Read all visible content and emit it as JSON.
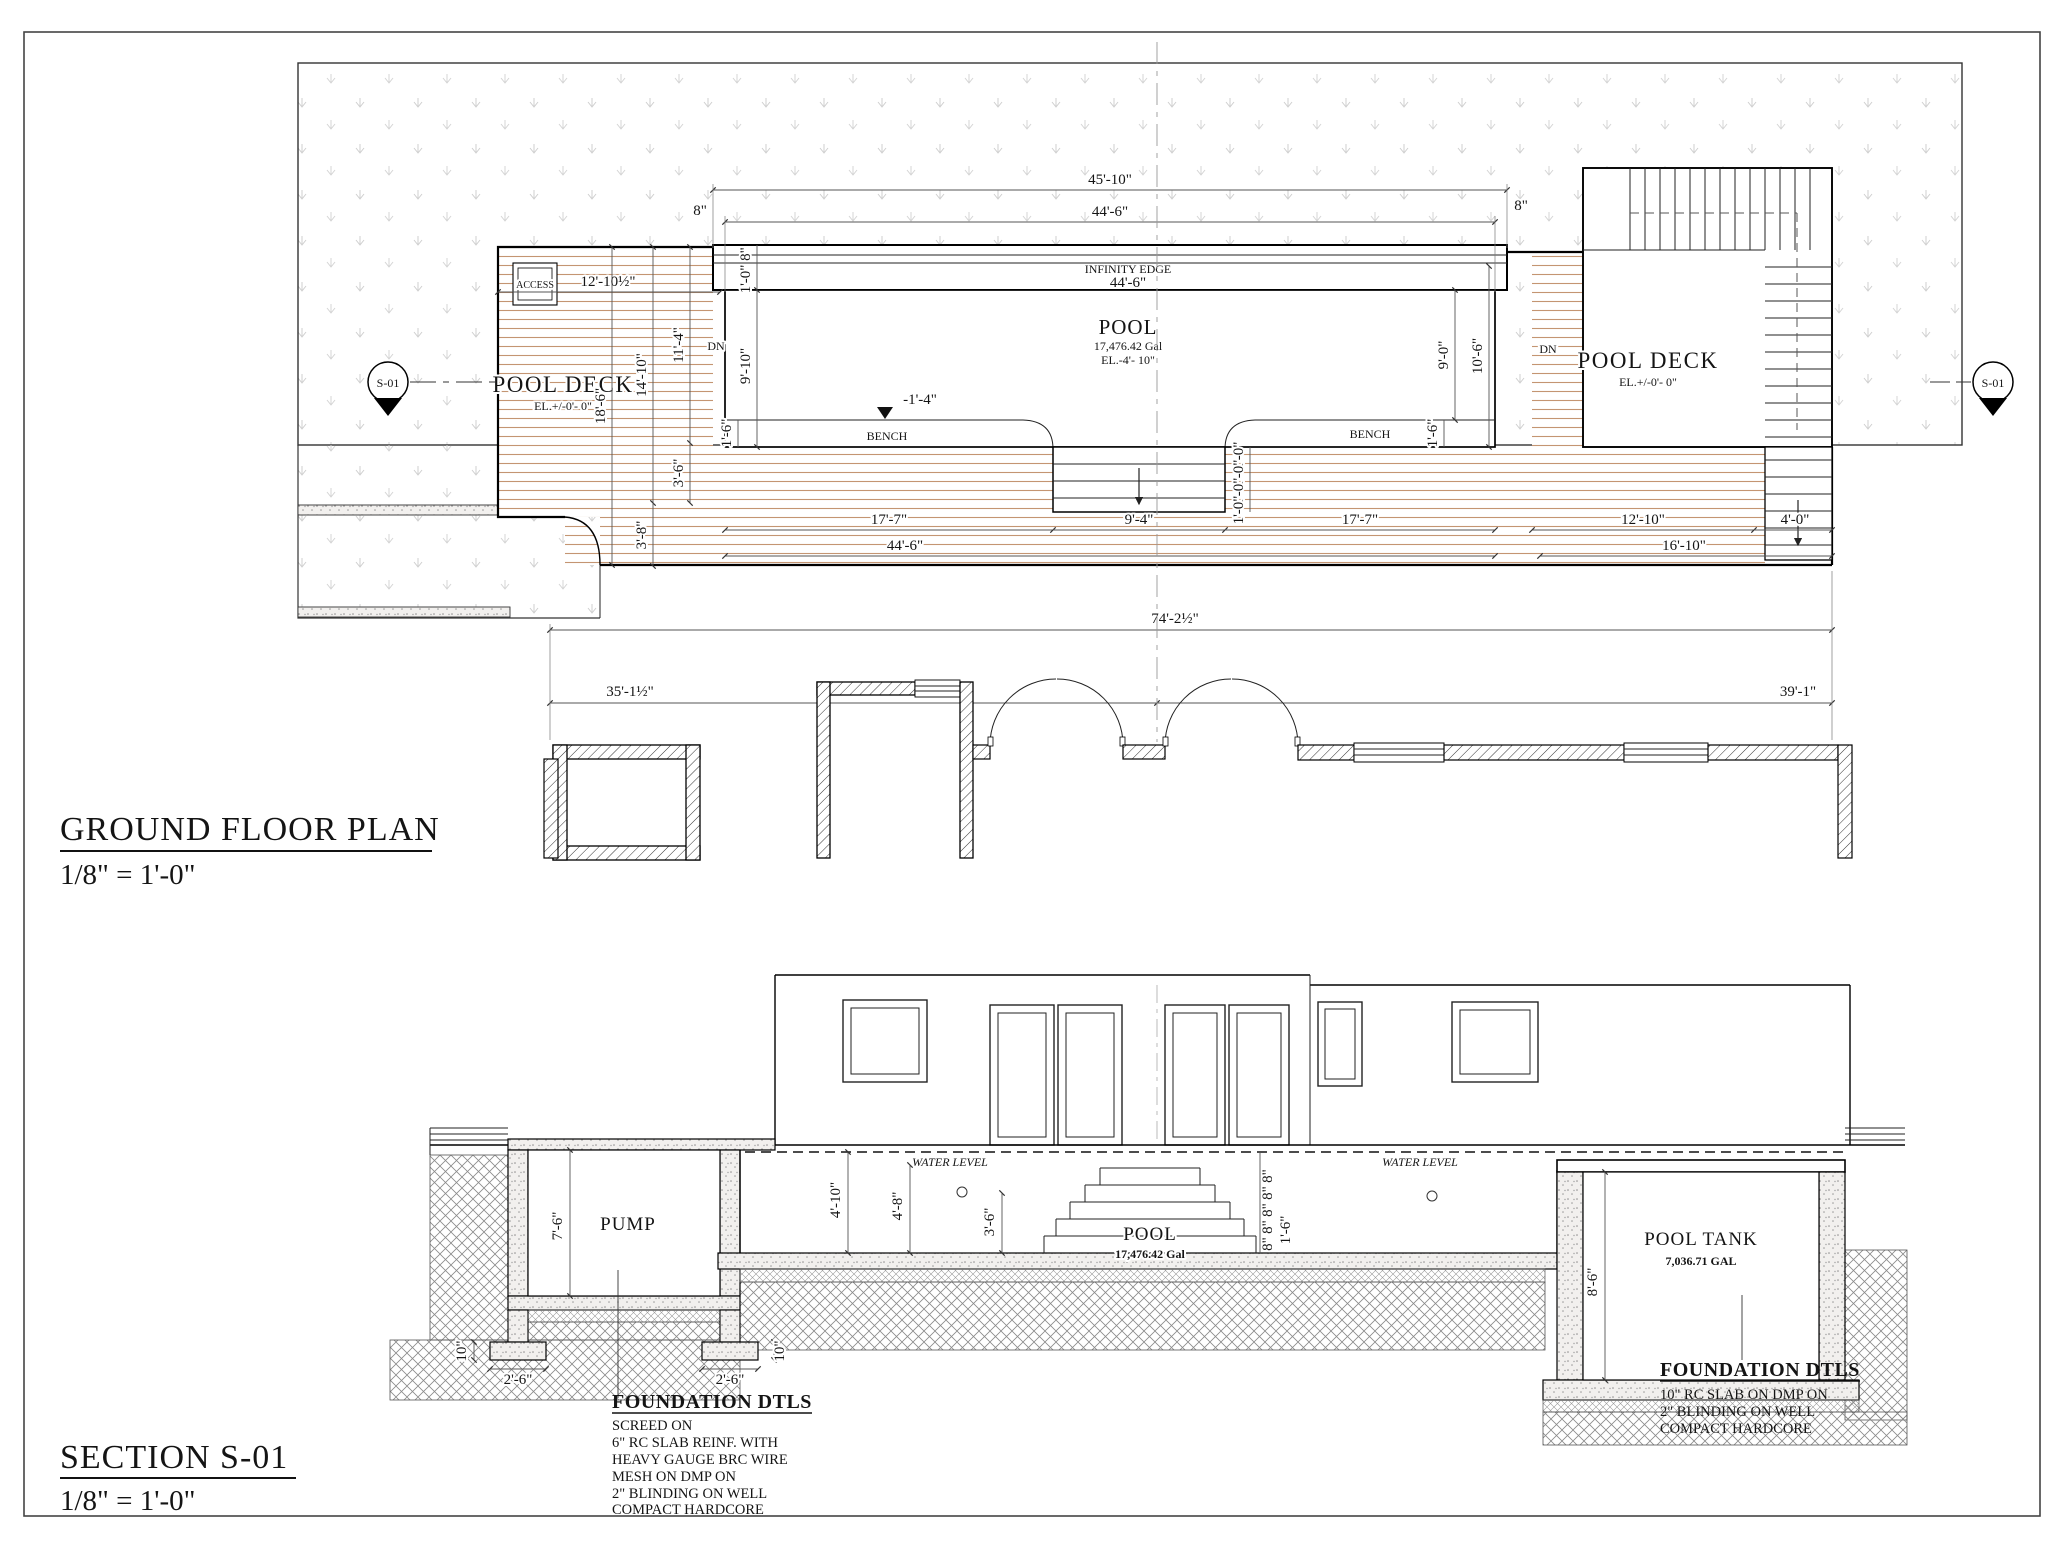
{
  "plan": {
    "title": "GROUND FLOOR PLAN",
    "scale": "1/8\"  =  1'-0\"",
    "marker": "S-01",
    "labels": {
      "pool_deck": "POOL DECK",
      "deck_elevation": "EL.+/-0'- 0\"",
      "pool": "POOL",
      "pool_volume": "17,476.42 Gal",
      "pool_elevation": "EL.-4'- 10\"",
      "infinity_edge": "INFINITY EDGE",
      "access": "ACCESS",
      "bench": "BENCH",
      "down": "DN",
      "water_elevation": "-1'-4\""
    },
    "dims": {
      "overall_top": "45'-10\"",
      "pool_length": "44'-6\"",
      "edge_gap": "8\"",
      "trough_width": "8\"",
      "trough_inner": "1'-0\"",
      "pool_side": "9'-10\"",
      "access_width": "12'-10½\"",
      "deck_11_4": "11'-4\"",
      "deck_14_10": "14'-10\"",
      "deck_18_6": "18'-6\"",
      "bench_width": "1'-6\"",
      "pool_right_9_0": "9'-0\"",
      "pool_right_10_6": "10'-6\"",
      "walk_3_6": "3'-6\"",
      "walk_3_8": "3'-8\"",
      "bench_run": "17'-7\"",
      "steps_width": "9'-4\"",
      "deck_right_12_10": "12'-10\"",
      "stair_4_0": "4'-0\"",
      "deck_right_16_10": "16'-10\"",
      "overall": "74'-2½\"",
      "house_left": "35'-1½\"",
      "house_right": "39'-1\"",
      "step_tread": "1'-0\""
    }
  },
  "section": {
    "title": "SECTION S-01",
    "scale": "1/8\"  =  1'-0\"",
    "labels": {
      "pump": "PUMP",
      "pool": "POOL",
      "pool_volume": "17,476.42 Gal",
      "tank": "POOL TANK",
      "tank_volume": "7,036.71 GAL",
      "water_level": "WATER LEVEL"
    },
    "dims": {
      "pump_depth": "7'-6\"",
      "footing_width": "2'-6\"",
      "footing_depth": "10\"",
      "pool_depth_1": "4'-10\"",
      "pool_depth_2": "4'-8\"",
      "steps_height": "3'-6\"",
      "riser": "8\"",
      "base_riser": "1'-6\"",
      "tank_depth": "8'-6\""
    },
    "foundation_left": {
      "heading": "FOUNDATION DTLS",
      "lines": [
        "SCREED ON",
        "6\" RC SLAB REINF. WITH",
        "HEAVY GAUGE BRC WIRE",
        "MESH ON DMP ON",
        "2\" BLINDING ON WELL",
        "COMPACT HARDCORE"
      ]
    },
    "foundation_right": {
      "heading": "FOUNDATION DTLS",
      "lines": [
        "10\" RC SLAB ON DMP ON",
        "2\" BLINDING ON WELL",
        "COMPACT HARDCORE"
      ]
    }
  }
}
